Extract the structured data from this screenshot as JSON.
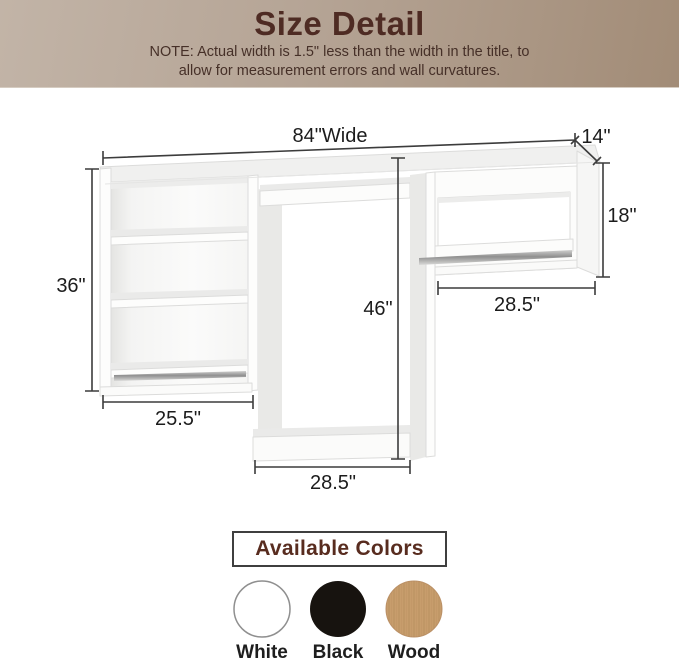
{
  "header": {
    "title": "Size Detail",
    "note_line1": "NOTE: Actual width is 1.5\" less than the width in the title, to",
    "note_line2": "allow for measurement errors and wall curvatures."
  },
  "diagram": {
    "dim_overall_width": "84\"Wide",
    "dim_depth": "14\"",
    "dim_right_section_height": "18\"",
    "dim_right_section_width": "28.5\"",
    "dim_left_section_height": "36\"",
    "dim_left_section_width": "25.5\"",
    "dim_middle_height": "46\"",
    "dim_middle_width": "28.5\""
  },
  "available_colors": {
    "title": "Available Colors",
    "swatches": [
      {
        "name": "White",
        "hex": "#ffffff"
      },
      {
        "name": "Black",
        "hex": "#17130f"
      },
      {
        "name": "Wood",
        "hex": "#c79d6c"
      }
    ]
  },
  "palette": {
    "header_gradient_left": "#c2b4a7",
    "header_gradient_right": "#a28c77",
    "header_text": "#4e2b23",
    "dimension_line": "#3c3c3c",
    "dimension_text": "#1c1c1c",
    "furniture_shade": "#e9e9e7"
  }
}
